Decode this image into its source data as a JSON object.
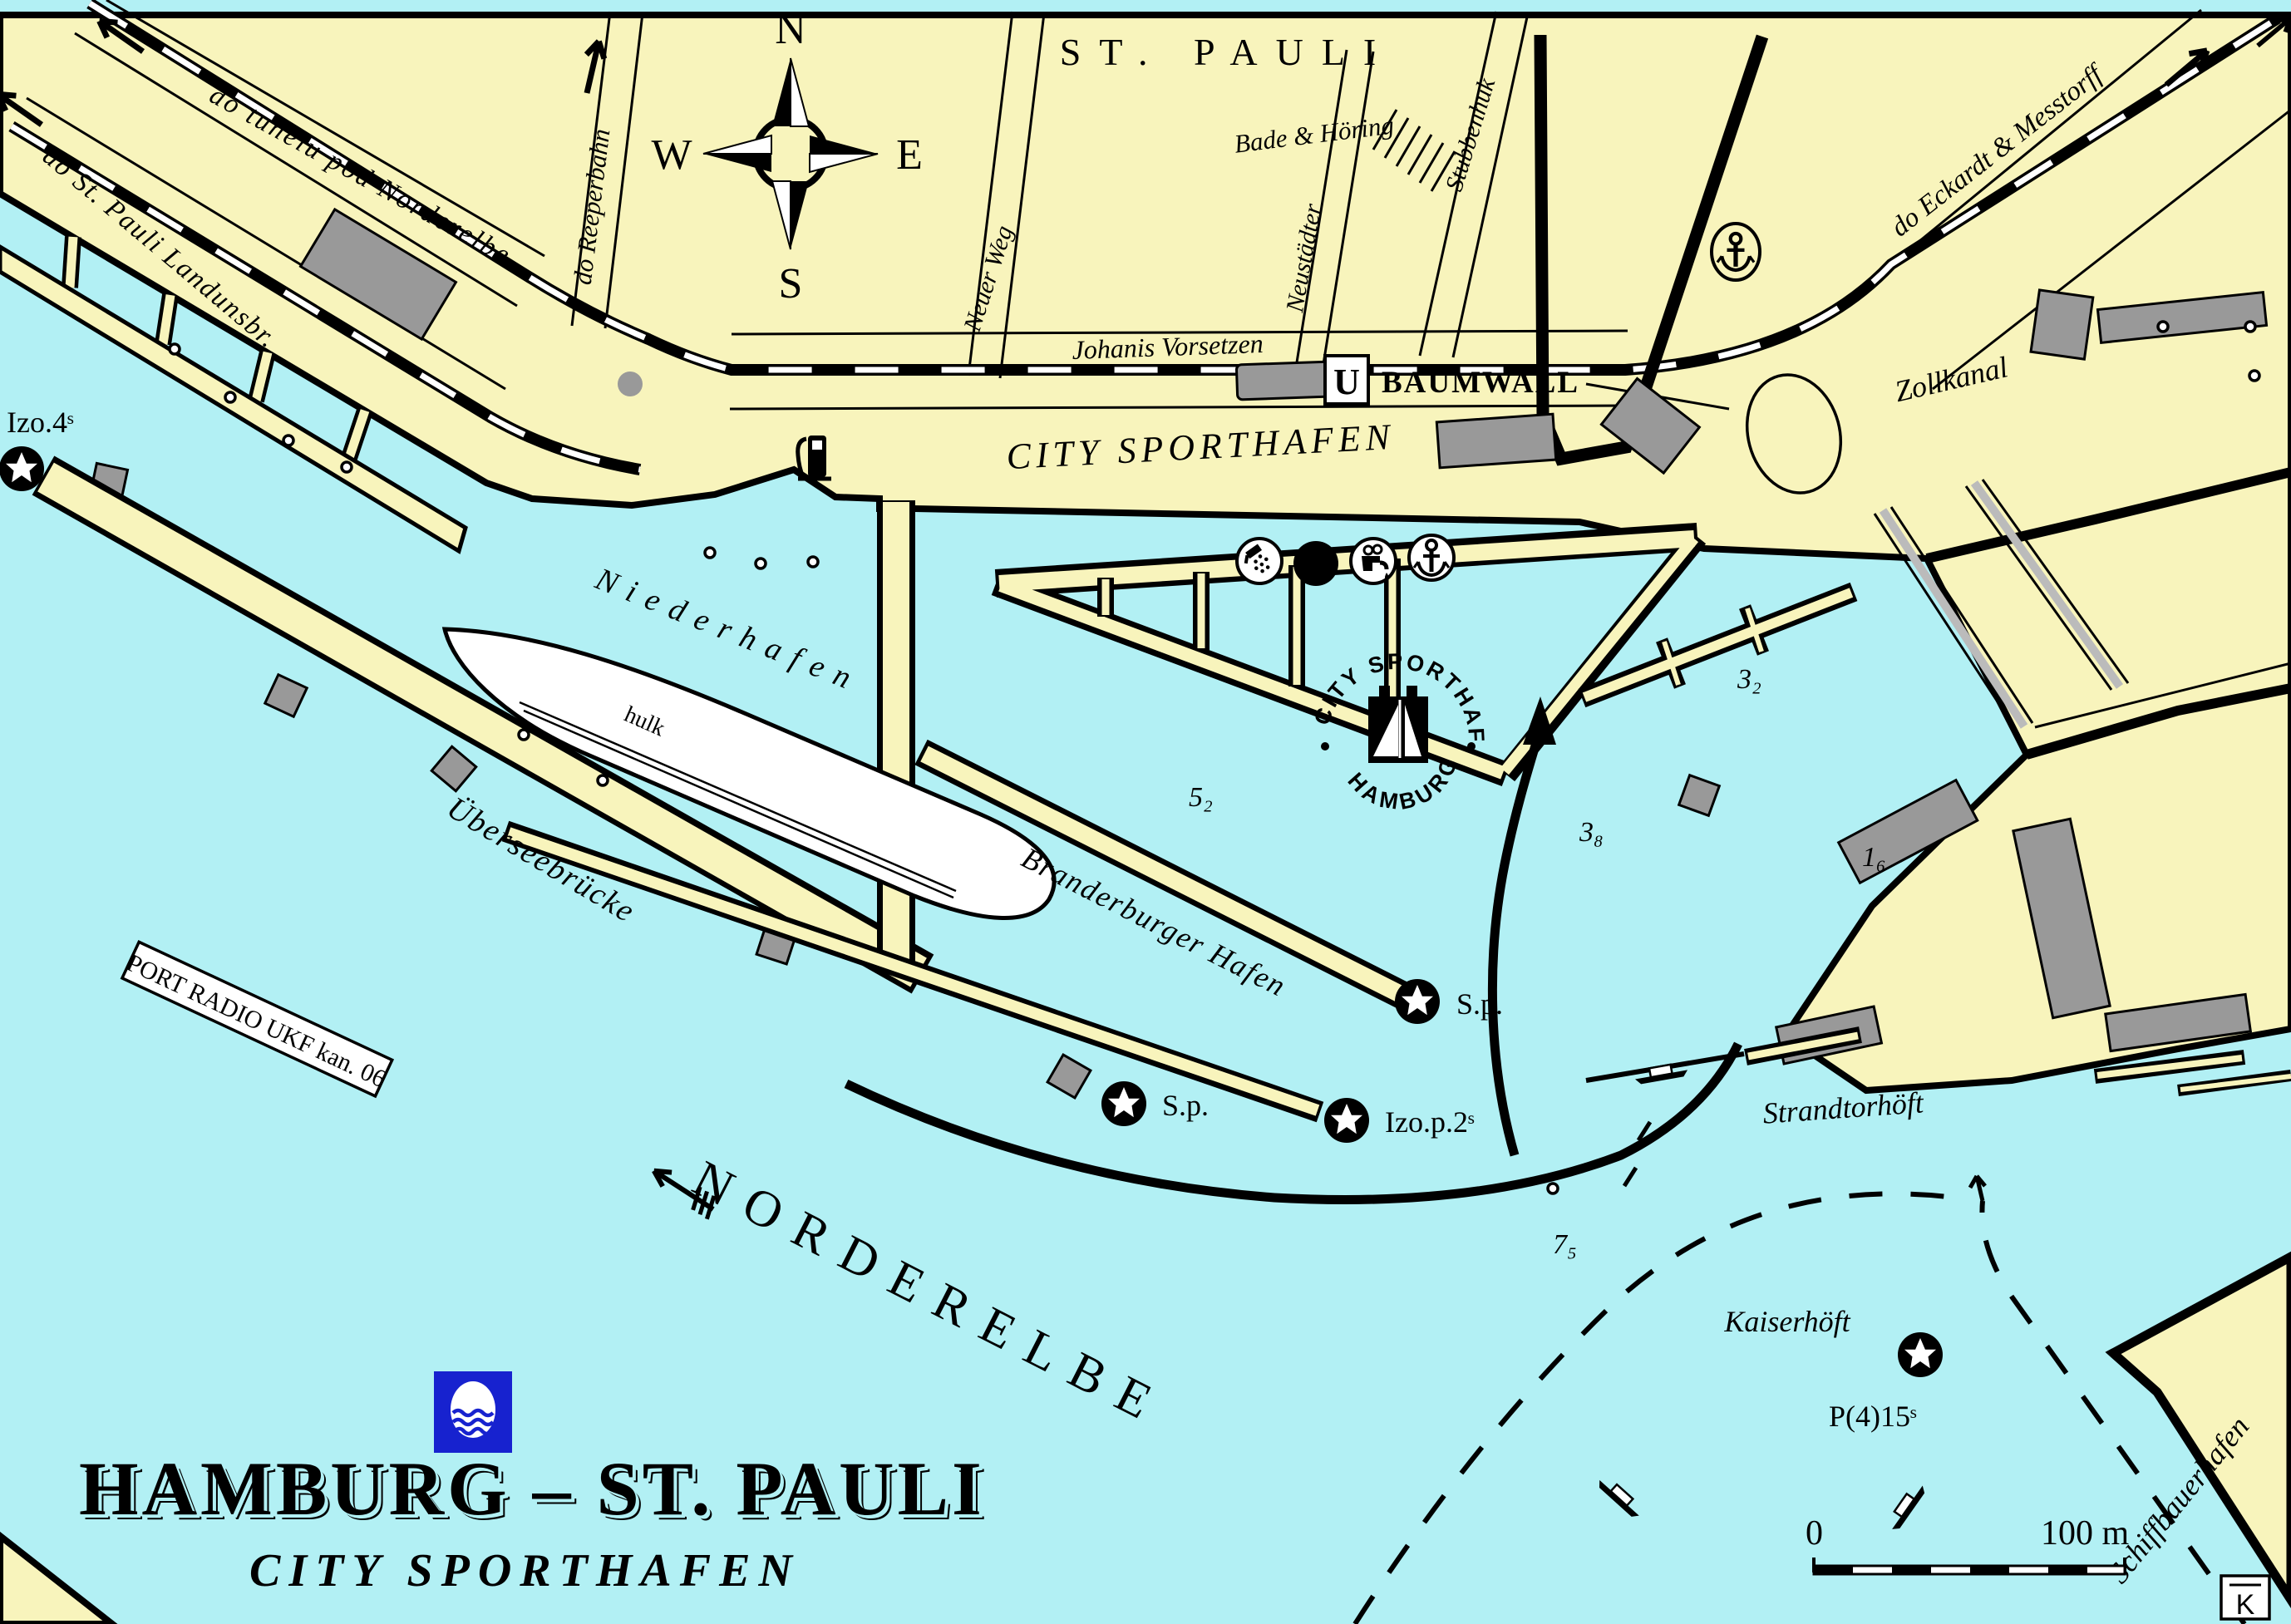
{
  "labels": {
    "tunelu": "do tunelu pod Norderelbe",
    "landungsbr": "do St. Pauli Landunsbr.",
    "reeperbahn": "do Reeperbahn",
    "neuer_weg": "Neuer Weg",
    "neustadter": "Neustädter",
    "johanis": "Johanis Vorsetzen",
    "st_pauli": "ST.  PAULI",
    "bade": "Bade & Höring",
    "stubbenhuk": "Stubbenhuk",
    "eckardt": "do Eckardt & Messtorff",
    "zollkanal": "Zollkanal",
    "city_sporthafen": "CITY  SPORTHAFEN",
    "niederhafen": "Niederhafen",
    "hulk": "hulk",
    "uberseebrucke": "Überseebrücke",
    "branderburger": "Branderburger Hafen",
    "norderelbe": "NORDERELBE",
    "strandtorhoft": "Strandtorhöft",
    "kaiserhoft": "Kaiserhöft",
    "schiffbauerhafen": "Schiffbauerhafen",
    "port_radio": "PORT RADIO  UKF  kan. 06"
  },
  "station": {
    "badge": "U",
    "name": "BAUMWALL"
  },
  "lights": {
    "izo4": "Izo.4ˢ",
    "sp1": "S.p.",
    "sp2": "S.p.",
    "izop2": "Izo.p.2ˢ",
    "p415": "P(4)15ˢ"
  },
  "depths": {
    "d52": "5₂",
    "d38": "3₈",
    "d32": "3₂",
    "d16": "1₆",
    "d75": "7₅"
  },
  "compass": {
    "n": "N",
    "w": "W",
    "e": "E",
    "s": "S"
  },
  "icons": {
    "wc": "WC"
  },
  "logo": {
    "top": "CITY SPORTHAFEN",
    "bottom": "HAMBURG"
  },
  "title": {
    "main": "HAMBURG – ST. PAULI",
    "sub": "CITY  SPORTHAFEN"
  },
  "scale": {
    "zero": "0",
    "hundred": "100 m"
  },
  "corner_mark": "K",
  "colors": {
    "water": "#b2f0f4",
    "land": "#f8f4bc",
    "building": "#999999",
    "flag_blue": "#1722cf"
  }
}
